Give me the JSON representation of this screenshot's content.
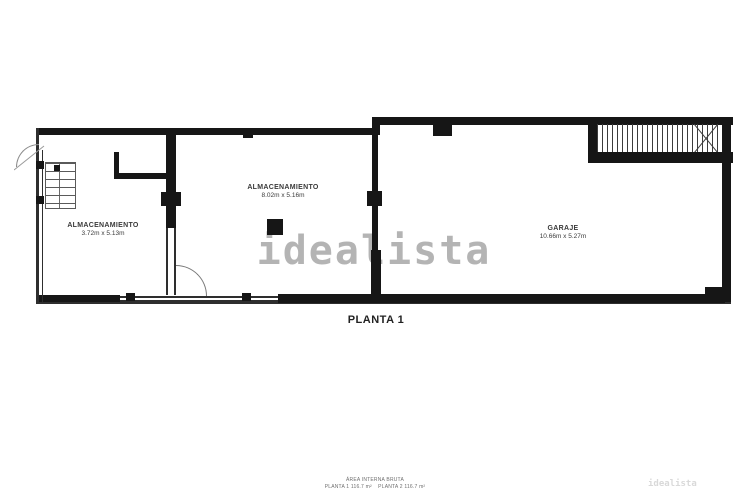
{
  "plan": {
    "title": "PLANTA 1",
    "watermark": "idealista",
    "watermark_small": "idealista",
    "rooms": [
      {
        "name": "ALMACENAMIENTO",
        "dims": "3.72m x 5.13m"
      },
      {
        "name": "ALMACENAMIENTO",
        "dims": "8.02m x 5.16m"
      },
      {
        "name": "GARAJE",
        "dims": "10.66m x 5.27m"
      }
    ],
    "footer": {
      "line1": "ÁREA INTERNA BRUTA",
      "line2": "PLANTA 1 116.7 m²    PLANTA 2 116.7 m²"
    },
    "colors": {
      "wall": "#161616",
      "watermark": "#7d7d7d",
      "background": "#ffffff"
    }
  }
}
